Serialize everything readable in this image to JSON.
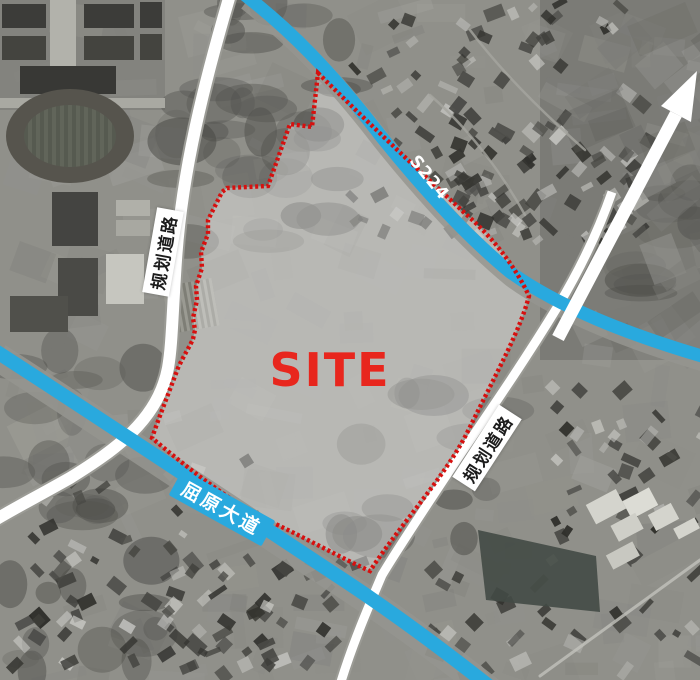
{
  "map": {
    "site_label": "SITE",
    "road_labels": {
      "s224": "S224",
      "quyuan_avenue": "屈原大道",
      "planned_road_west": "规划道路",
      "planned_road_east": "规划道路"
    },
    "colors": {
      "road_blue": "#29a9de",
      "road_white": "#ffffff",
      "boundary_red": "#d6100f",
      "site_label_red": "#e8261d",
      "label_text_dark": "#1c1c1c"
    }
  }
}
